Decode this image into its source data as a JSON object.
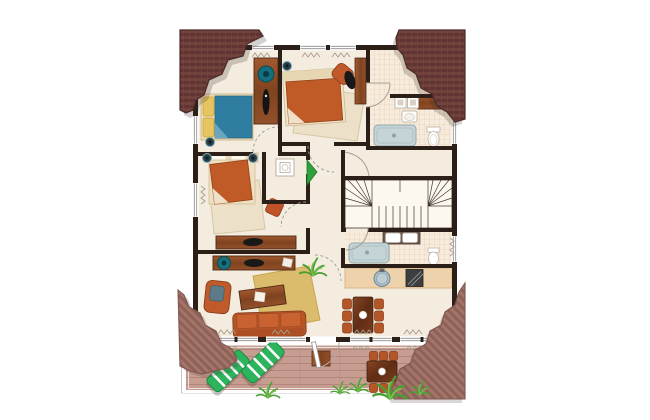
{
  "palette": {
    "background": "#ffffff",
    "wall": "#2c1f18",
    "floor": "#f3ecdf",
    "tile": "#f7ecdb",
    "tile_line": "#e4c5ae",
    "roof_dark": "#71413c",
    "roof_light": "#a3746a",
    "deck": "#c79d91",
    "wood": "#8a4a2c",
    "upholstery_orange": "#c05a2a",
    "blanket_orange": "#c05a26",
    "blanket_blue": "#2f7ea1",
    "pillow_yellow": "#e7c45f",
    "rug_yellow": "#d9ba66",
    "rug_beige": "#ece1c8",
    "bathtub": "#c5d4d7",
    "lounger_green": "#2db45c",
    "plant_green": "#4a9e35",
    "door_accent_green": "#2fa13b",
    "counter_tan": "#eed2ab",
    "teal_accent": "#16707e"
  },
  "plan": {
    "kind": "apartment-upper-floor-plan-with-terrace",
    "rooms": [
      {
        "name": "bedroom-1",
        "furniture": [
          "double-bed-blue-with-yellow-pillows",
          "dresser-with-mirror",
          "wall-lamp"
        ]
      },
      {
        "name": "bedroom-2",
        "furniture": [
          "double-bed-orange",
          "area-rug",
          "armchair",
          "desk",
          "desk-chair",
          "wall-lamp"
        ]
      },
      {
        "name": "bathroom-1",
        "furniture": [
          "bathtub",
          "toilet",
          "washbasin",
          "washer-dryer-pair",
          "wood-counter"
        ]
      },
      {
        "name": "storage-closet",
        "furniture": [
          "washing-machine"
        ]
      },
      {
        "name": "bedroom-3",
        "furniture": [
          "double-bed-orange",
          "area-rug",
          "pouf",
          "sideboard",
          "desk-chair"
        ]
      },
      {
        "name": "hallway",
        "furniture": []
      },
      {
        "name": "stair-hall",
        "furniture": [
          "u-shaped-staircase"
        ]
      },
      {
        "name": "bathroom-2",
        "furniture": [
          "bathtub",
          "double-washbasin",
          "toilet"
        ]
      },
      {
        "name": "living-room",
        "furniture": [
          "three-seat-sofa",
          "recliner-with-cushion",
          "coffee-table",
          "yellow-rug",
          "sideboard-with-turntable",
          "desk-chair",
          "potted-plant"
        ]
      },
      {
        "name": "kitchen-dining",
        "furniture": [
          "kitchen-counter",
          "round-sink",
          "stove",
          "dining-table",
          "dining-chairs"
        ]
      },
      {
        "name": "terrace",
        "furniture": [
          "sun-loungers",
          "side-table",
          "outdoor-dining-table",
          "outdoor-chairs",
          "grass-plants",
          "railing"
        ]
      }
    ],
    "counts": {
      "bedrooms": 3,
      "bathrooms": 2,
      "sun_loungers": 2,
      "dining_chairs_inside": 6,
      "dining_chairs_terrace": 6,
      "roof_corner_patches": 4,
      "grass_plants_terrace": 5
    }
  }
}
